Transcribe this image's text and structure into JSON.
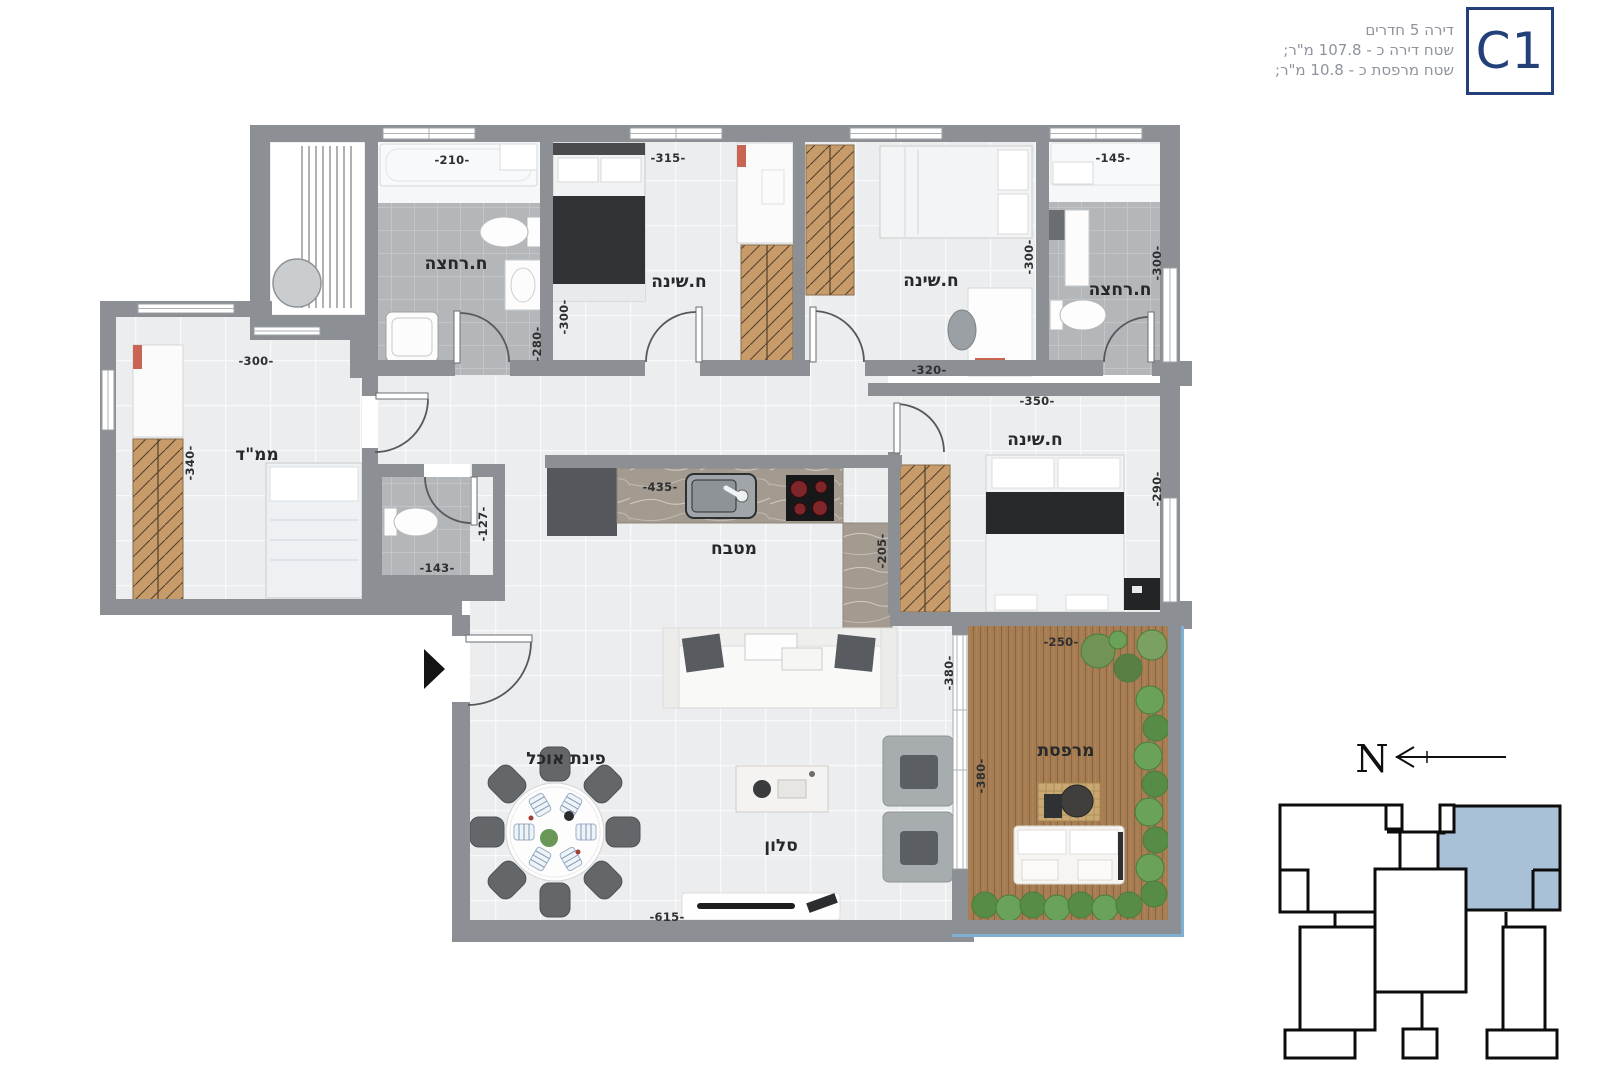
{
  "header": {
    "unit_code": "C1",
    "line1": "דירה 5 חדרים",
    "line2": "שטח דירה כ - 107.8 מ\"ר;",
    "line3": "שטח מרפסת כ - 10.8 מ\"ר;"
  },
  "rooms": {
    "bath1": "ח.רחצה",
    "bed2": "ח.שינה",
    "bed3": "ח.שינה",
    "bath2": "ח.רחצה",
    "mamad": "ממ\"ד",
    "kitchen": "מטבח",
    "master": "ח.שינה",
    "dining": "פינת אוכל",
    "living": "סלון",
    "balcony": "מרפסת"
  },
  "dims": {
    "bath1_top": "-210-",
    "bed2_top": "-315-",
    "bath2_top": "-145-",
    "mamad_top": "-300-",
    "mamad_left": "-340-",
    "bed2_left_upper": "-300-",
    "bed2_left_lower": "-280-",
    "bed3_bottom": "-320-",
    "bed3_right": "-300-",
    "bath2_right": "-300-",
    "master_top": "-350-",
    "master_right": "-290-",
    "wc_bottom": "-143-",
    "wc_right": "-127-",
    "kitchen_top": "-435-",
    "kitchen_side": "-205-",
    "living_bottom": "-615-",
    "living_balcony": "-380-",
    "balcony_top": "-250-",
    "balcony_side": "-380-"
  },
  "compass": {
    "north": "N"
  },
  "colors": {
    "accent_navy": "#24407b",
    "key_plan_unit_fill": "#a9c1d6",
    "balcony_rail_blue": "#7fb0d4",
    "wall_gray": "#8c9094"
  }
}
